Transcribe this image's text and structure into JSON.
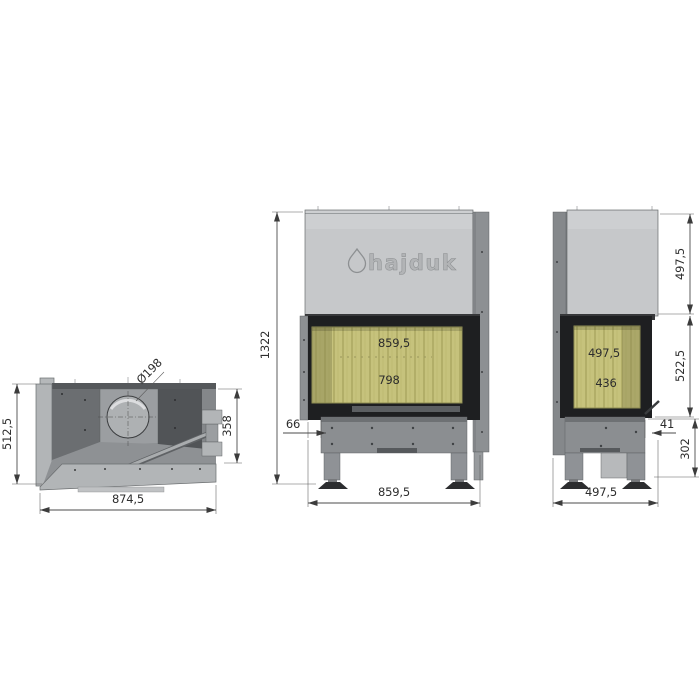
{
  "brand": {
    "logo_text": "hajduk"
  },
  "top_view": {
    "depth": "512,5",
    "width": "874,5",
    "firebox_side_depth": "358",
    "flue_diameter": "Ø198"
  },
  "front_view": {
    "total_height": "1322",
    "glass_width": "859,5",
    "glass_opening_width": "798",
    "left_offset": "66",
    "overall_width": "859,5"
  },
  "side_view": {
    "hood_height": "497,5",
    "firebox_section_height": "522,5",
    "glass_depth": "497,5",
    "glass_opening_depth": "436",
    "right_offset": "41",
    "base_height": "302",
    "overall_depth": "497,5"
  },
  "colors": {
    "hood_gray": "#c6c8ca",
    "steel_gray": "#8b8e91",
    "frame_dark": "#1e1f21",
    "vermiculite": "#c6c27c",
    "dimension": "#4b4b4b"
  }
}
